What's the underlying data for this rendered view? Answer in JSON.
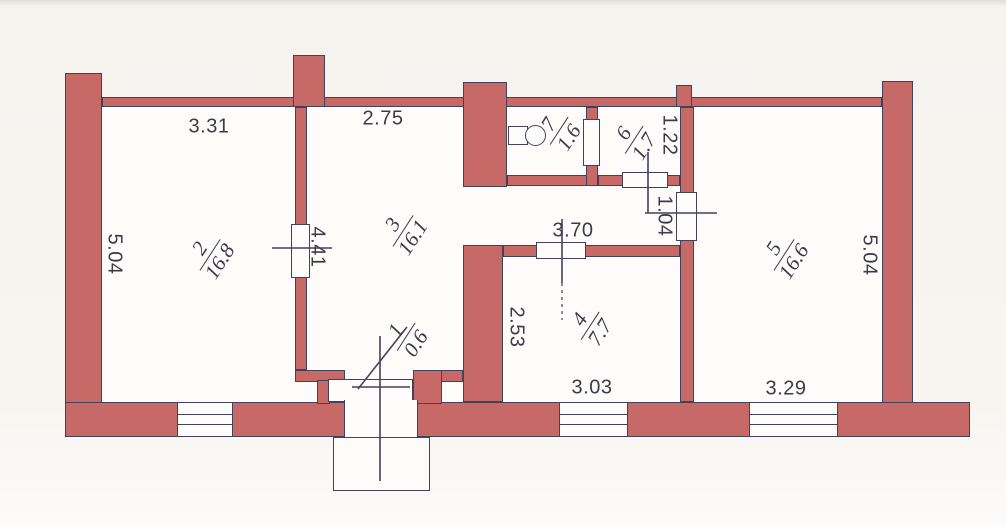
{
  "plan": {
    "type": "apartment-floor-plan",
    "colors": {
      "wall_fill": "#c76a67",
      "outline": "#42425a",
      "paper": "#f8f5f1"
    },
    "rooms": [
      {
        "number": "1",
        "area": "0.6"
      },
      {
        "number": "2",
        "area": "16.8"
      },
      {
        "number": "3",
        "area": "16.1"
      },
      {
        "number": "4",
        "area": "7.7"
      },
      {
        "number": "5",
        "area": "16.6"
      },
      {
        "number": "6",
        "area": "1.7"
      },
      {
        "number": "7",
        "area": "1.6"
      }
    ],
    "dimensions": {
      "room2_top": "3.31",
      "room3_top": "2.75",
      "room2_left": "5.04",
      "door_room2_room3": "4.41",
      "hall_width": "3.70",
      "room4_left": "2.53",
      "room4_bottom": "3.03",
      "room5_bottom": "3.29",
      "room5_right": "5.04",
      "room6_width": "1.22",
      "door_room5": "1.04"
    }
  }
}
